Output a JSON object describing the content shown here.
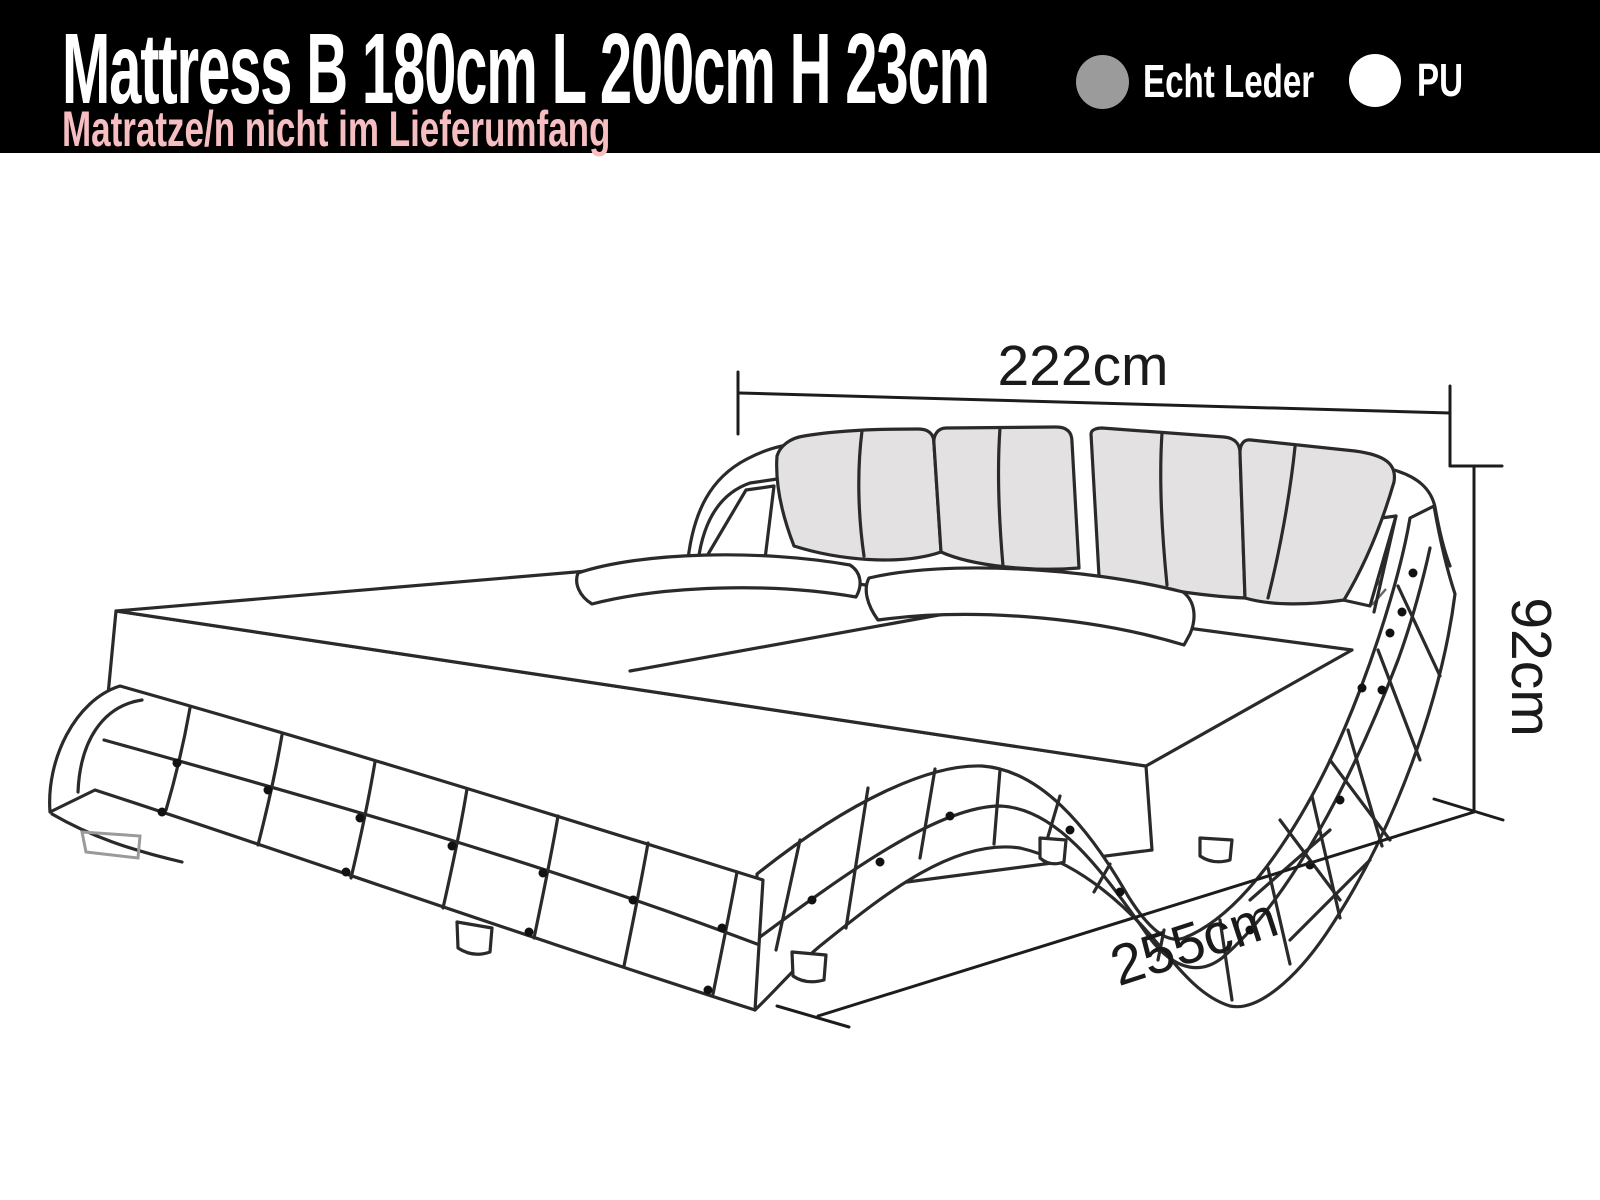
{
  "banner": {
    "title": "Mattress B 180cm L 200cm H 23cm",
    "subtitle": "Matratze/n nicht im Lieferumfang",
    "background_color": "#000000",
    "title_color": "#ffffff",
    "subtitle_color": "#f6bec1"
  },
  "legend": {
    "items": [
      {
        "label": "Echt Leder",
        "swatch_color": "#9b9b9b"
      },
      {
        "label": "PU",
        "swatch_color": "#ffffff"
      }
    ]
  },
  "diagram": {
    "type": "product-dimension-line-drawing",
    "subject": "wave-shaped upholstered bed with tufted frame and four back cushions",
    "line_color": "#2a2a2a",
    "cushion_fill_color": "#e3e1e2",
    "dimensions": {
      "width_label": "222cm",
      "height_label": "92cm",
      "length_label": "255cm"
    }
  }
}
